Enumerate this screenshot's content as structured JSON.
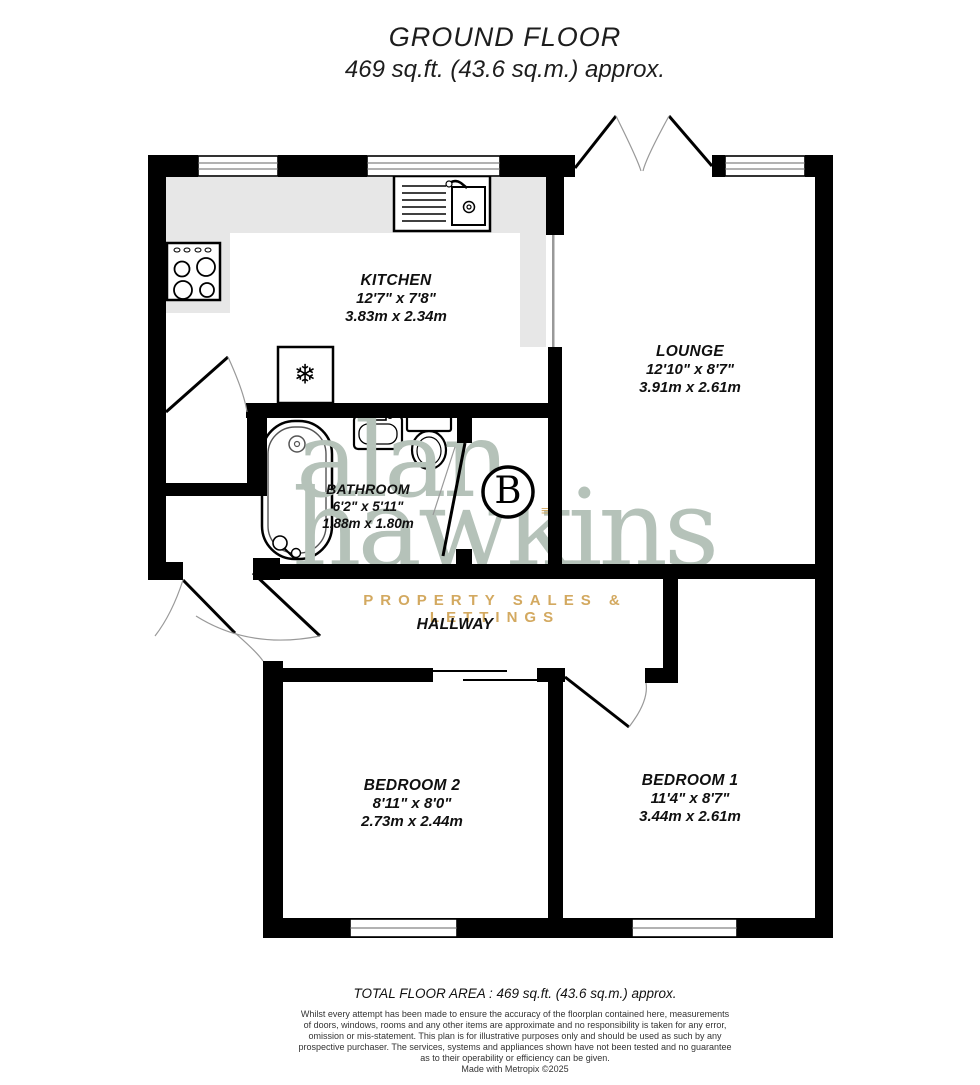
{
  "title": {
    "line1": "GROUND FLOOR",
    "line2": "469 sq.ft. (43.6 sq.m.) approx."
  },
  "rooms": {
    "kitchen": {
      "name": "KITCHEN",
      "imperial": "12'7\"  x 7'8\"",
      "metric": "3.83m  x 2.34m"
    },
    "lounge": {
      "name": "LOUNGE",
      "imperial": "12'10\"  x 8'7\"",
      "metric": "3.91m  x 2.61m"
    },
    "bathroom": {
      "name": "BATHROOM",
      "imperial": "6'2\"  x 5'11\"",
      "metric": "1.88m  x 1.80m"
    },
    "hallway": {
      "name": "HALLWAY"
    },
    "bedroom2": {
      "name": "BEDROOM 2",
      "imperial": "8'11\"  x 8'0\"",
      "metric": "2.73m  x 2.44m"
    },
    "bedroom1": {
      "name": "BEDROOM 1",
      "imperial": "11'4\"  x 8'7\"",
      "metric": "3.44m  x 2.61m"
    }
  },
  "symbols": {
    "boiler": "B",
    "fridge_freezer": "❄"
  },
  "watermark": {
    "line1": "alan",
    "line2": "hawkins",
    "tagline": "PROPERTY SALES & LETTINGS",
    "mark": "≡"
  },
  "footer": {
    "total": "TOTAL FLOOR AREA : 469 sq.ft. (43.6 sq.m.) approx.",
    "disclaimer": [
      "Whilst every attempt has been made to ensure the accuracy of the floorplan contained here, measurements",
      "of doors, windows, rooms and any other items are approximate and no responsibility is taken for any error,",
      "omission or mis-statement. This plan is for illustrative purposes only and should be used as such by any",
      "prospective purchaser. The services, systems and appliances shown have not been tested and no guarantee",
      "as to their operability or efficiency can be given.",
      "Made with Metropix ©2025"
    ]
  },
  "colors": {
    "wall": "#000000",
    "counter": "#e7e7e7",
    "watermark_green": "#b5c2b9",
    "brand_gold": "#d3a960"
  }
}
